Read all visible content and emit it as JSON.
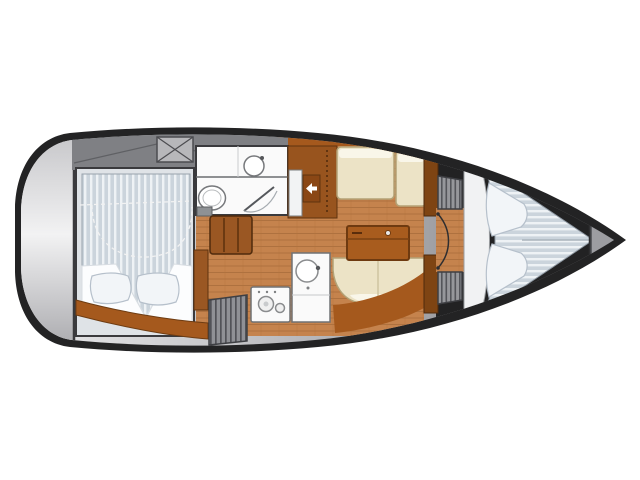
{
  "diagram": {
    "type": "sailboat-interior-floorplan",
    "orientation": "bow-right-stern-left",
    "areas": [
      "swim-platform",
      "cockpit",
      "cockpit-locker",
      "aft-cabin-double-berth",
      "head-with-toilet-sink-shower",
      "companionway-steps",
      "slatted-hatch",
      "galley-stove",
      "galley-sink",
      "salon-settees",
      "salon-table",
      "entry-arrow",
      "bulkhead-lockers",
      "v-berth-forward-cabin",
      "anchor-locker"
    ]
  },
  "colors": {
    "background": "#ffffff",
    "hull": "#232324",
    "deck_light": "#ebebed",
    "deck_dark": "#9a9a9e",
    "cockpit_gray": "#7f8084",
    "stern_light": "#f2f2f3",
    "cabin_trim_brown": "#a5591d",
    "cabinet_brown": "#98541e",
    "bulkhead_brown": "#7e4413",
    "steps_brown": "#9a5723",
    "table_brown": "#a85c1e",
    "wood_floor": "#c5834d",
    "wood_line": "#9a6232",
    "upholstery_cream": "#ece3c6",
    "upholstery_highlight": "#f9f6e9",
    "upholstery_edge": "#b3a276",
    "mattress_base": "#cbd4dc",
    "mattress_stripe": "#eef2f5",
    "bedding_white": "#fcfdfe",
    "pillow_fill": "#f2f5f8",
    "pillow_edge": "#b6c0cb",
    "fixture_white": "#fafafa",
    "fixture_outline": "#707274",
    "locker_gray": "#96979b",
    "locker_stripe": "#54555a",
    "bow_locker_gray": "#9c9da1",
    "arrow_white": "#ffffff",
    "dashed_line": "#f2f2f2"
  }
}
